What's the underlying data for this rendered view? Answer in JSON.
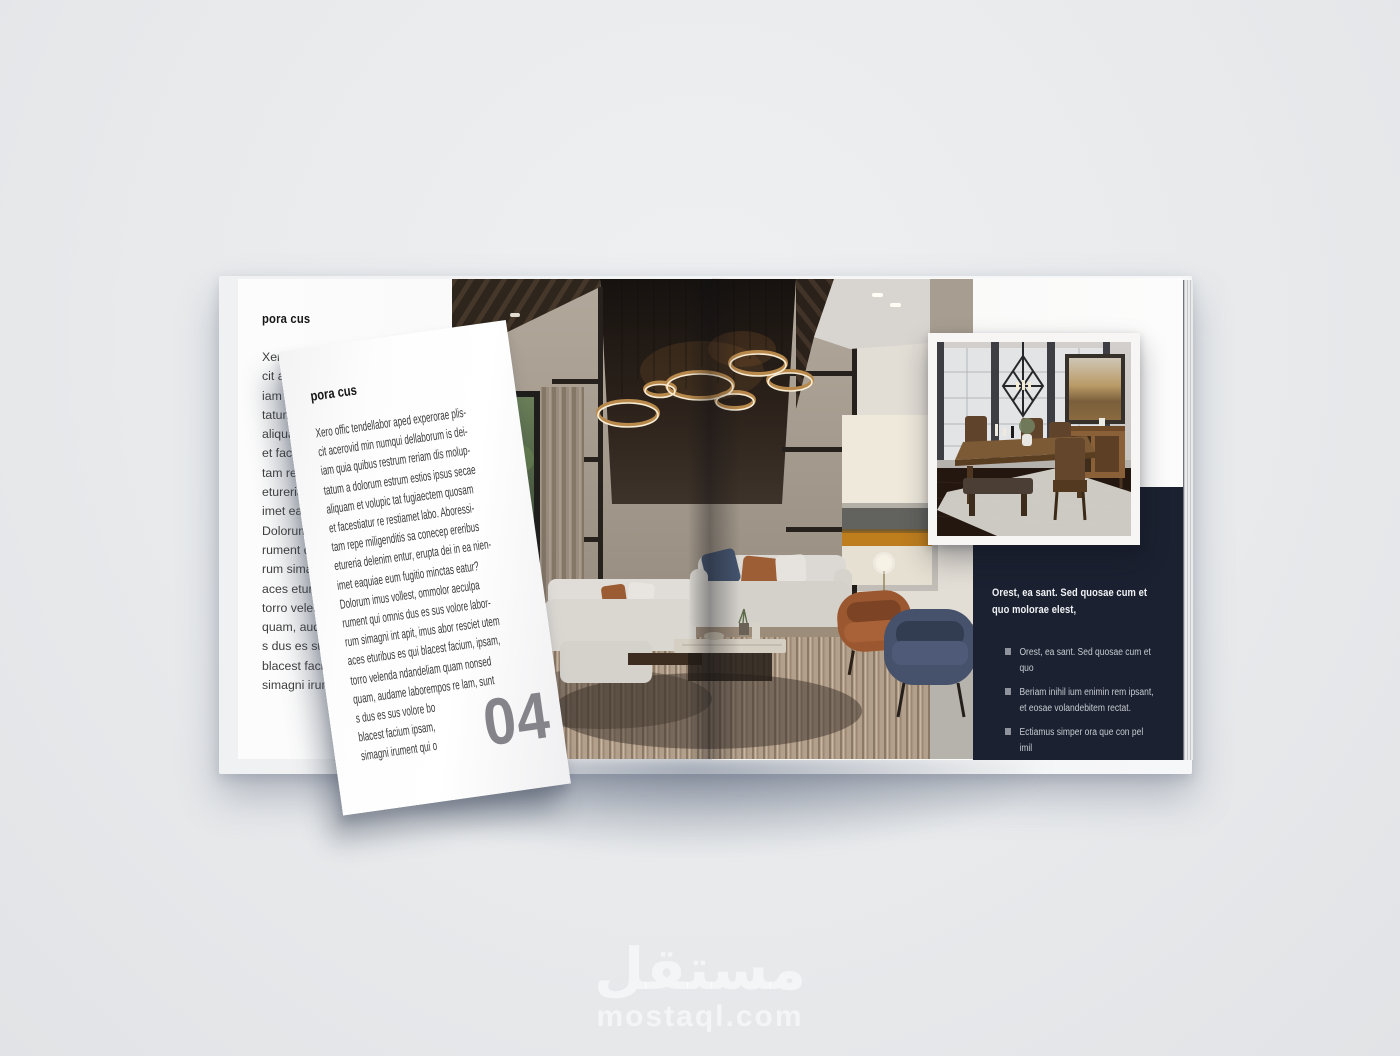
{
  "colors": {
    "background": "#e9ebed",
    "panel_bg": "#1b2130",
    "page_number_gray": "#84848a"
  },
  "article": {
    "heading": "pora cus",
    "body_lines": [
      "Xero offic tendellabor aped experorae plis-",
      "cit acerovid min numqui dellaborum is dei-",
      "iam quia quibus restrum reriam dis molup-",
      "tatum a dolorum estrum estios ipsus secae",
      "aliquam et volupic tat fugiaectem quosam",
      "et facestiatur re restiamet labo. Aboressi-",
      "tam repe miligenditis sa conecep ereribus",
      "etureria delenim entur, erupta dei in ea nien-",
      "imet eaquiae eum fugitio minctas eatur?",
      "Dolorum imus vollest, ommolor aeculpa",
      "rument qui omnis dus es sus volore labor-",
      "rum simagni int apit, imus abor resciet utem",
      "aces eturibus es qui blacest facium, ipsam,",
      "torro velenda ndandeliam quam nonsed",
      "quam, audame laborempos re lam, sunt",
      "s dus es sus volore bo",
      "blacest facium ipsam,",
      "simagni irument qui o"
    ]
  },
  "turning_page": {
    "heading": "pora cus",
    "page_number": "04"
  },
  "panel": {
    "heading": "Orest, ea sant. Sed quosae cum et quo molorae elest,",
    "bullets": [
      "Orest, ea sant. Sed quosae cum et quo",
      "Beriam inihil ium enimin rem ipsant, et eosae volandebitem rectat.",
      "Ectiamus simper ora que con pel imil"
    ]
  },
  "photos": {
    "main": "living-room-photo",
    "inset": "dining-room-photo"
  },
  "watermark": {
    "arabic": "مستقل",
    "domain": "mostaql.com"
  }
}
